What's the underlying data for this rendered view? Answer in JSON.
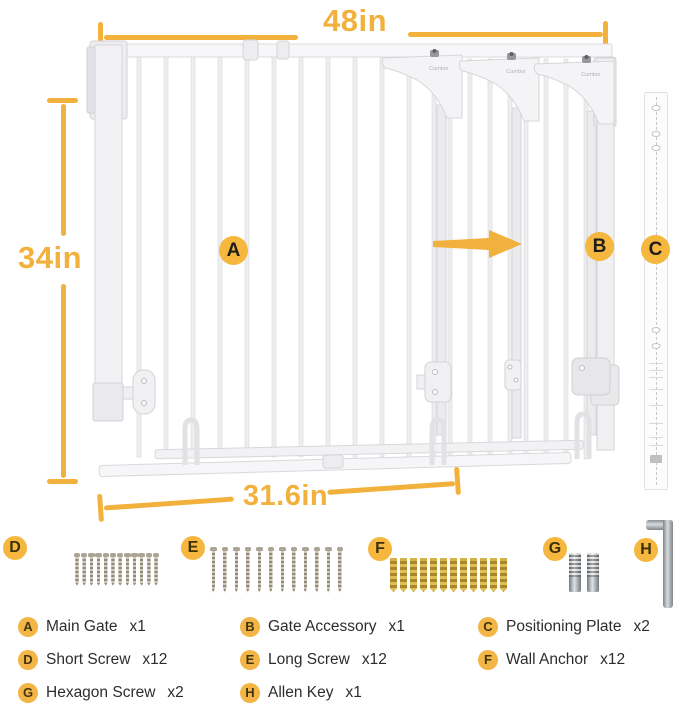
{
  "brand": "Cumbor",
  "colors": {
    "accent": "#F2B13C",
    "badge_fill": "#F5B73E",
    "screw_metal": "#A8A195",
    "anchor_yellow": "#CDA63B",
    "tool_gray": "#9CA1A5",
    "gate_white": "#F2F2F4"
  },
  "dimensions": {
    "top": "48in",
    "left": "34in",
    "bottom": "31.6in"
  },
  "markers": {
    "main_gate": "A",
    "gate_accessory": "B",
    "positioning_plate": "C",
    "short_screw": "D",
    "long_screw": "E",
    "wall_anchor": "F",
    "hexagon_screw": "G",
    "allen_key": "H"
  },
  "hardware_counts": {
    "short_screws": 12,
    "long_screws": 12,
    "wall_anchors": 12,
    "hexagon_screws": 2,
    "allen_keys": 1
  },
  "parts_list": [
    {
      "badge": "A",
      "name": "Main Gate",
      "qty": "x1"
    },
    {
      "badge": "B",
      "name": "Gate Accessory",
      "qty": "x1"
    },
    {
      "badge": "C",
      "name": "Positioning Plate",
      "qty": "x2"
    },
    {
      "badge": "D",
      "name": "Short Screw",
      "qty": "x12"
    },
    {
      "badge": "E",
      "name": "Long Screw",
      "qty": "x12"
    },
    {
      "badge": "F",
      "name": "Wall Anchor",
      "qty": "x12"
    },
    {
      "badge": "G",
      "name": "Hexagon Screw",
      "qty": "x2"
    },
    {
      "badge": "H",
      "name": "Allen Key",
      "qty": "x1"
    }
  ]
}
